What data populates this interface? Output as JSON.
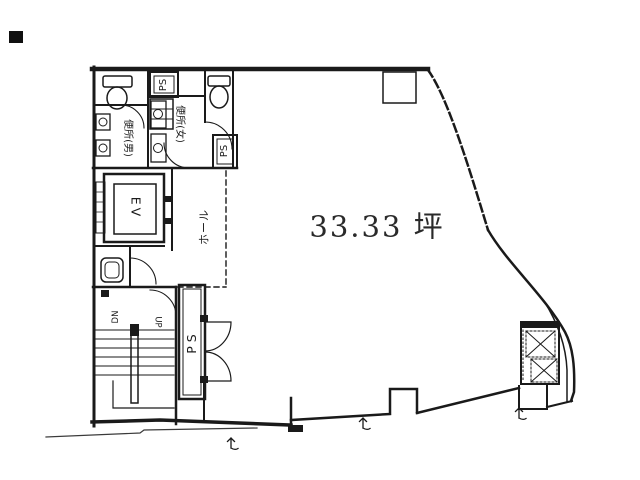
{
  "plan": {
    "area_label": "33.33 坪",
    "labels": {
      "toilet_men": "便所(男)",
      "toilet_women": "便所(女)",
      "elevator": "EV",
      "hall": "ホール",
      "ps_top": "PS",
      "ps_mid": "PS",
      "ps_shaft": "PS",
      "stairs_down": "DN",
      "stairs_up": "UP"
    },
    "colors": {
      "line": "#1a1a1a",
      "background": "#ffffff"
    }
  }
}
